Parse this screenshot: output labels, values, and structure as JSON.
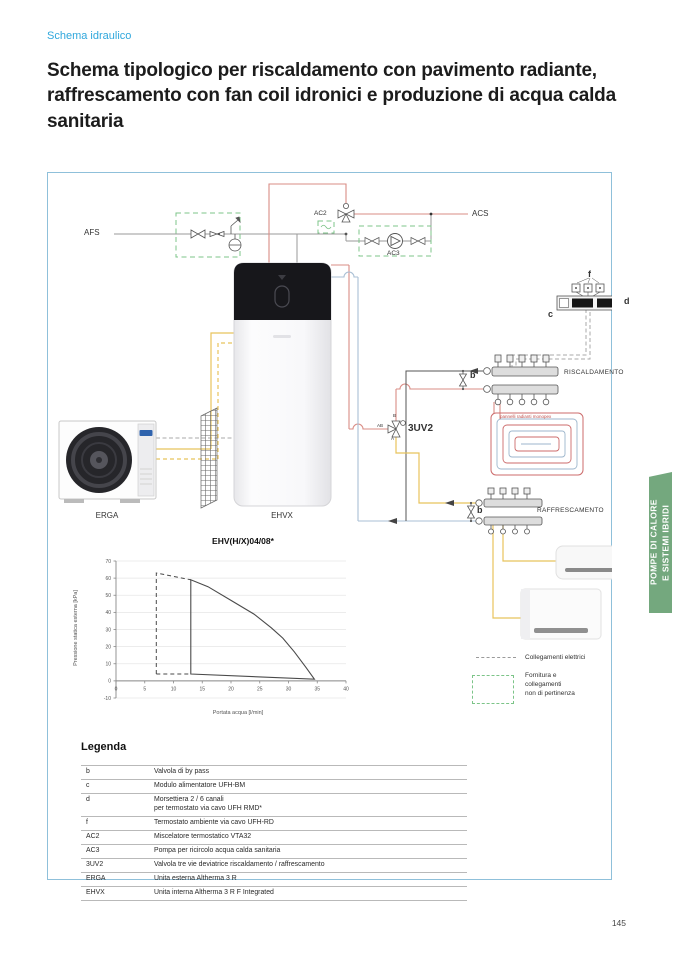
{
  "page": {
    "eyebrow": "Schema idraulico",
    "title": "Schema tipologico per riscaldamento con pavimento radiante, raffrescamento con fan coil idronici e produzione di acqua calda sanitaria",
    "page_number": "145",
    "side_tab": "POMPE DI CALORE\nE SISTEMI IBRIDI"
  },
  "colors": {
    "accent_blue": "#2fa7dc",
    "frame_border": "#8fc0da",
    "supply_red": "#d98c85",
    "return_blue": "#a9bfd4",
    "refrigerant_yellow": "#e8c35c",
    "boundary_green": "#7cc488",
    "tab_green": "#74a87e"
  },
  "diagram": {
    "labels": {
      "afs": "AFS",
      "acs": "ACS",
      "ac2": "AC2",
      "ac3": "AC3",
      "valve_3uv2": "3UV2",
      "port_ab": "AB",
      "port_b": "B",
      "port_a": "A",
      "bypass_heating": "b",
      "bypass_cooling": "b",
      "module_c": "c",
      "module_d": "d",
      "module_f": "f",
      "heating": "RISCALDAMENTO",
      "cooling": "RAFFRESCAMENTO",
      "radiant_note": "pannelli radianti monopex",
      "outdoor_unit": "ERGA",
      "indoor_unit": "EHVX"
    },
    "legend": [
      {
        "symbol": "dashed-line",
        "label": "Collegamenti elettrici"
      },
      {
        "symbol": "dashed-box",
        "label": "Fornitura e\ncollegamenti\nnon di pertinenza"
      }
    ]
  },
  "chart_data": {
    "type": "line",
    "title": "EHV(H/X)04/08*",
    "xlabel": "Portata acqua [l/min]",
    "ylabel": "Pressione statica esterna [kPa]",
    "xlim": [
      0,
      40
    ],
    "ylim": [
      -10,
      70
    ],
    "xticks": [
      0,
      5,
      10,
      15,
      20,
      25,
      30,
      35,
      40
    ],
    "yticks": [
      -10,
      0,
      10,
      20,
      30,
      40,
      50,
      60,
      70
    ],
    "grid": true,
    "legend_position": "none",
    "series": [
      {
        "name": "operating-envelope-min-speed",
        "style": "dashed",
        "points": [
          [
            7,
            4
          ],
          [
            7,
            63
          ],
          [
            13,
            59
          ]
        ]
      },
      {
        "name": "operating-envelope-min-base",
        "style": "dashed",
        "points": [
          [
            7,
            4
          ],
          [
            13,
            4
          ]
        ]
      },
      {
        "name": "operating-envelope-max-speed",
        "style": "solid",
        "closed": true,
        "points": [
          [
            13,
            4
          ],
          [
            13,
            59
          ],
          [
            16,
            55
          ],
          [
            20,
            47
          ],
          [
            24,
            39
          ],
          [
            27,
            31
          ],
          [
            29,
            25
          ],
          [
            31,
            17
          ],
          [
            33,
            8
          ],
          [
            34.5,
            1
          ]
        ]
      }
    ]
  },
  "legenda": {
    "heading": "Legenda",
    "rows": [
      [
        "b",
        "Valvola di by pass"
      ],
      [
        "c",
        "Modulo alimentatore UFH-BM"
      ],
      [
        "d",
        "Morsettiera 2 / 6 canali\nper termostato via cavo UFH RMD*"
      ],
      [
        "f",
        "Termostato ambiente via cavo UFH-RD"
      ],
      [
        "AC2",
        "Miscelatore termostatico VTA32"
      ],
      [
        "AC3",
        "Pompa per ricircolo acqua calda sanitaria"
      ],
      [
        "3UV2",
        "Valvola tre vie deviatrice riscaldamento / raffrescamento"
      ],
      [
        "ERGA",
        "Unita esterna Altherma 3 R"
      ],
      [
        "EHVX",
        "Unita interna Altherma 3 R F Integrated"
      ]
    ]
  }
}
